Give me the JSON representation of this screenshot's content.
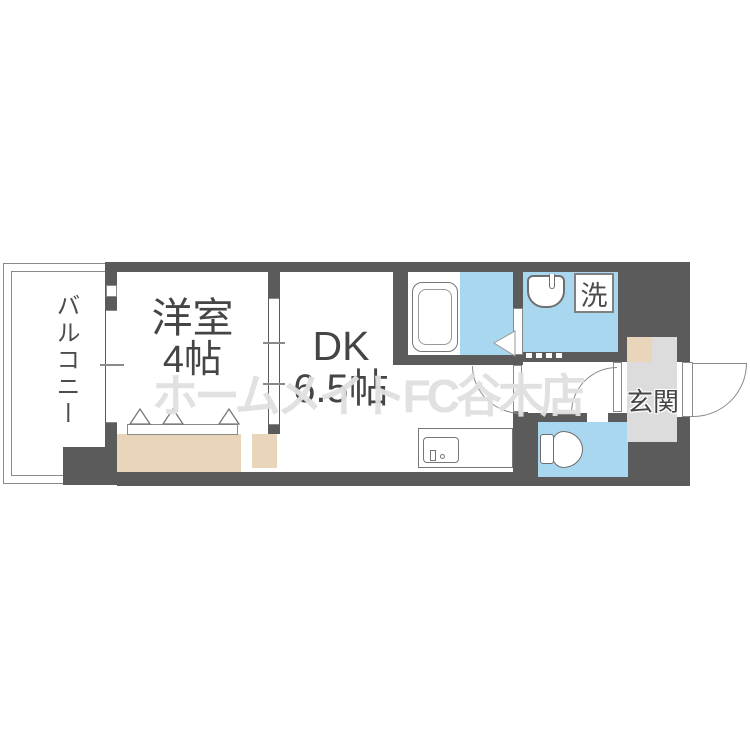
{
  "plan": {
    "balcony_label": "バルコニー",
    "western_room": {
      "label": "洋室",
      "size": "4帖"
    },
    "dk": {
      "label": "DK",
      "size": "6.5帖"
    },
    "laundry_label": "洗",
    "entrance_label": "玄関",
    "watermark_text": "ホームメイトFC谷木店",
    "icons": [
      "bathtub-icon",
      "washbasin-icon",
      "toilet-icon",
      "kitchen-sink-icon",
      "closet-fold-door-marks",
      "door-swing-arcs",
      "sliding-window-symbols"
    ],
    "colors": {
      "wall": "#5b5b5b",
      "water_area": "#a9d7f0",
      "closet": "#e9d6ba",
      "entrance_floor": "#dcdcdc",
      "outline": "#8a8a8a",
      "label_text": "#454545",
      "watermark": "#e0e0e0"
    }
  }
}
